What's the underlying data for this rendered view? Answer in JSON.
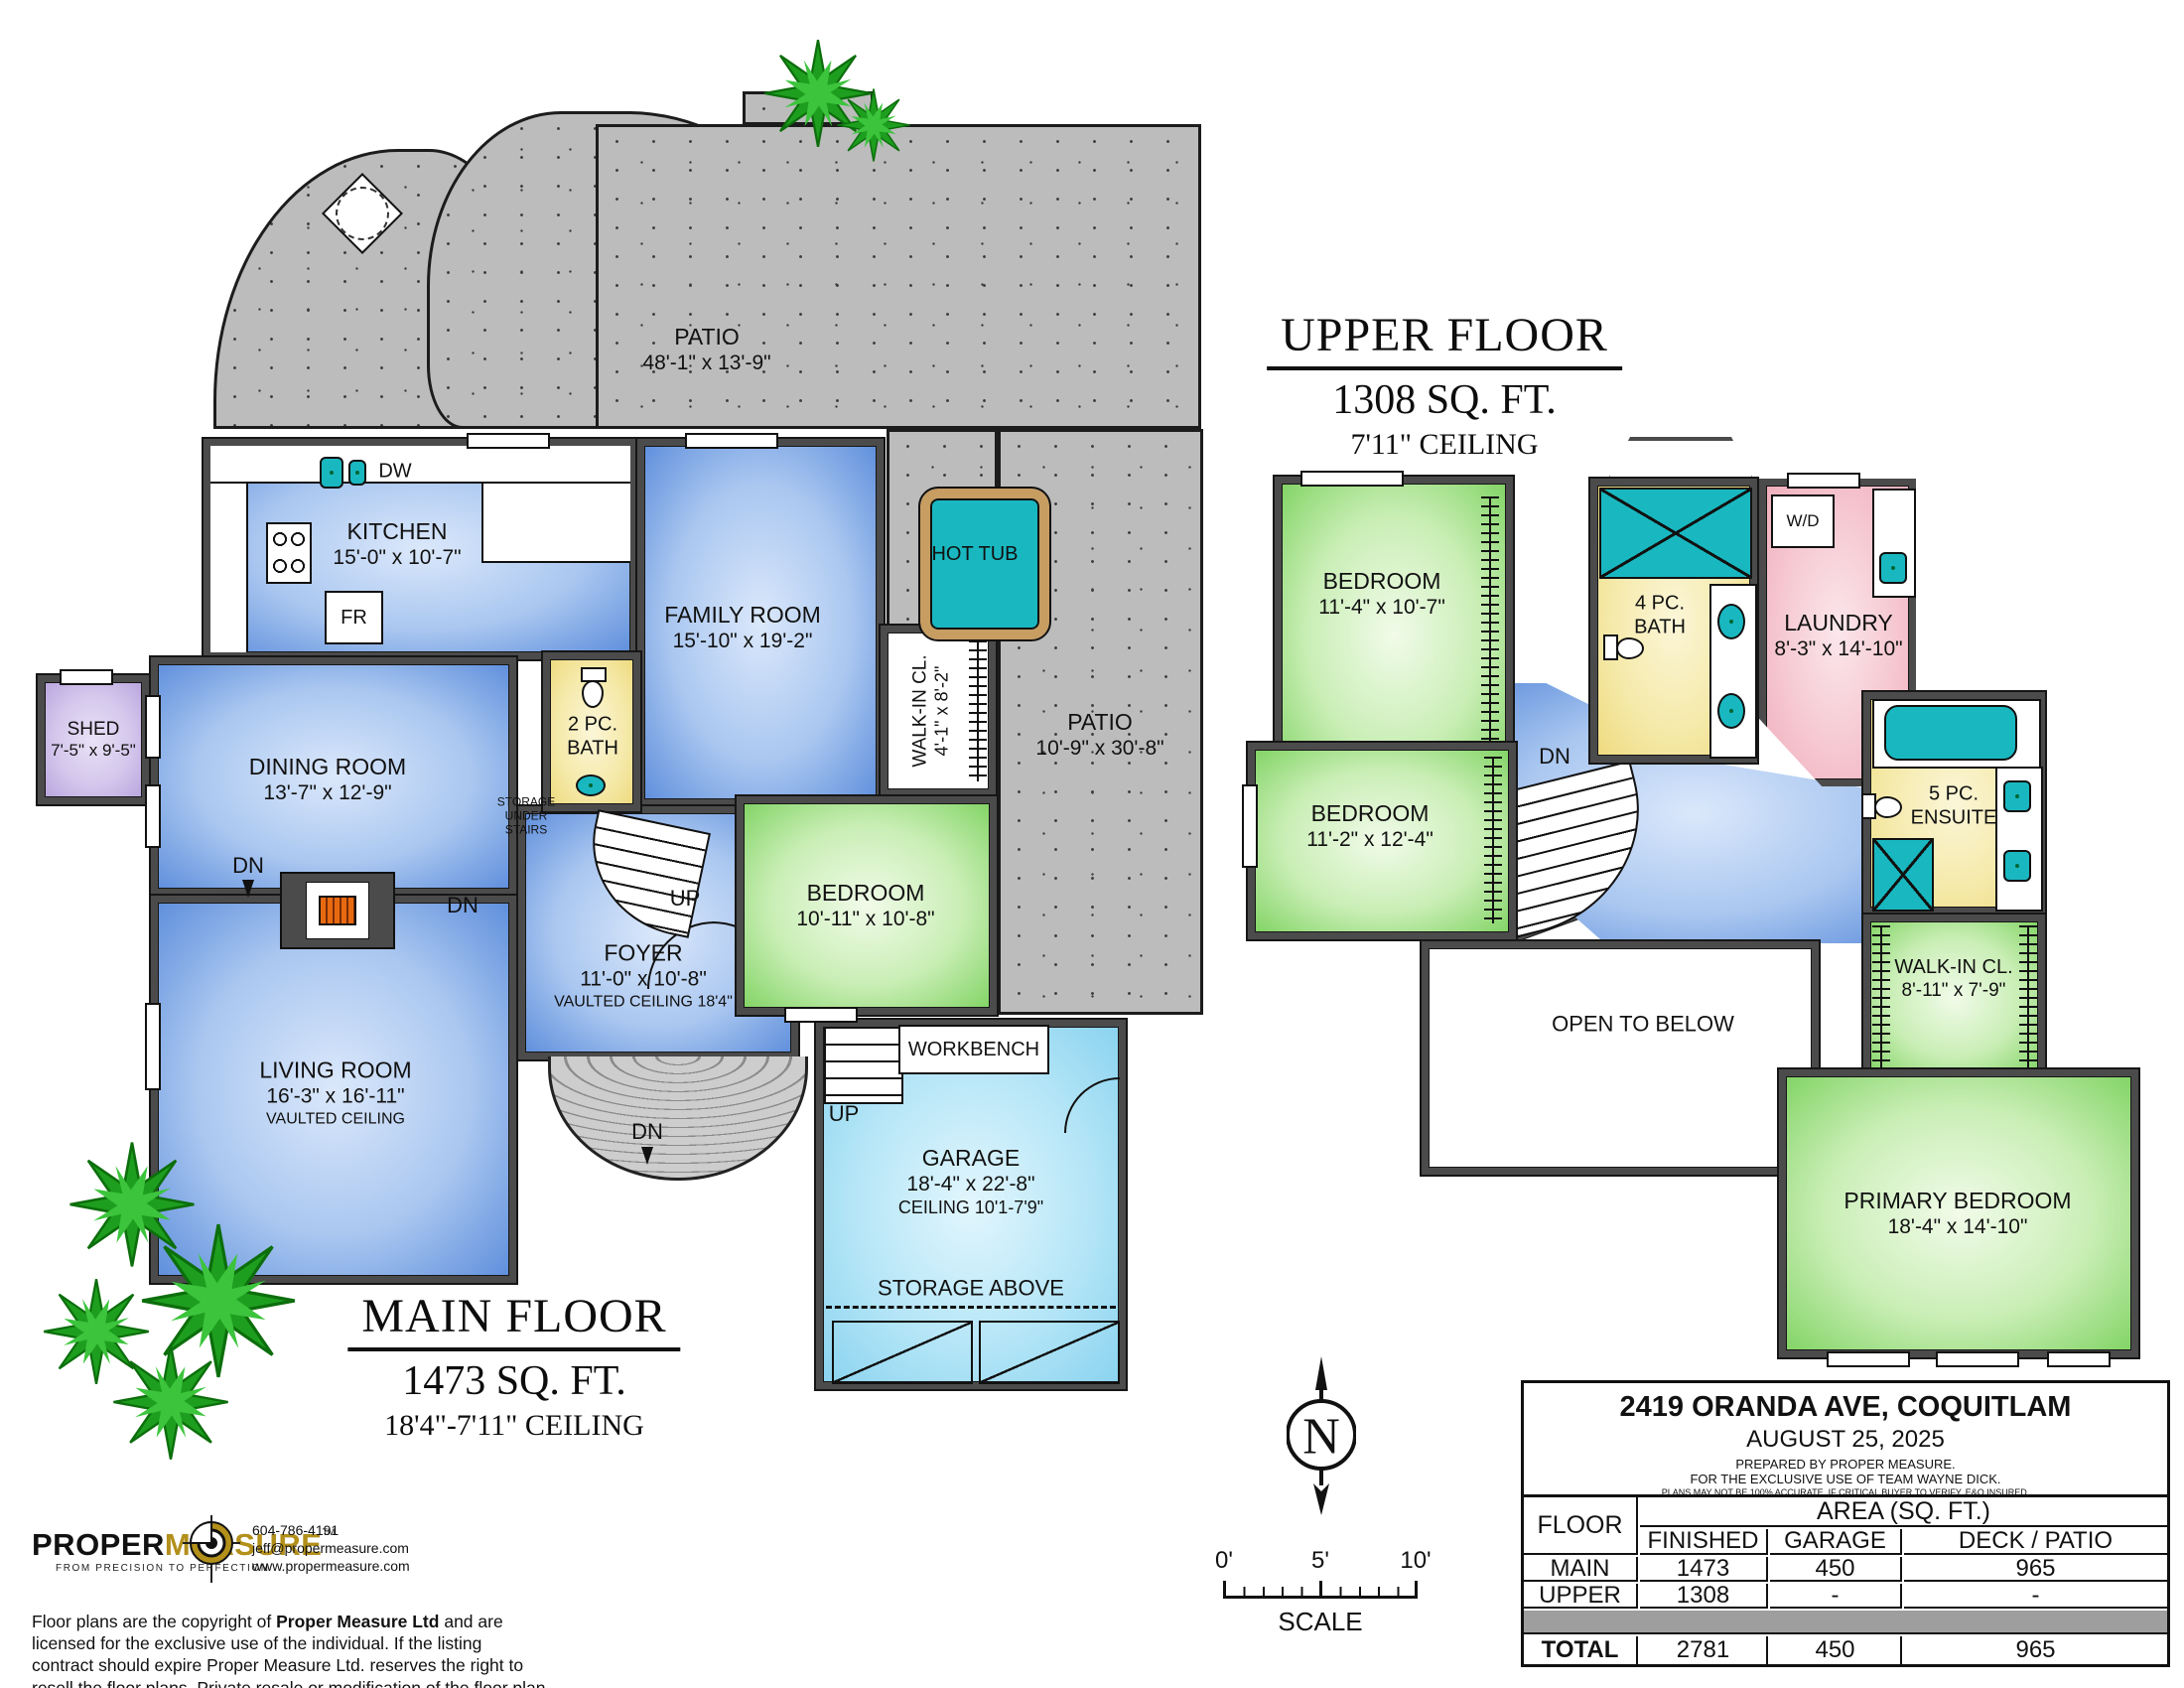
{
  "main": {
    "title": "MAIN FLOOR",
    "area": "1473 SQ. FT.",
    "ceiling": "18'4\"-7'11\" CEILING",
    "patio_top": {
      "name": "PATIO",
      "dims": "48'-1\" x 13'-9\""
    },
    "patio_right": {
      "name": "PATIO",
      "dims": "10'-9\" x 30'-8\""
    },
    "kitchen": {
      "name": "KITCHEN",
      "dims": "15'-0\" x 10'-7\""
    },
    "family": {
      "name": "FAMILY ROOM",
      "dims": "15'-10\" x 19'-2\""
    },
    "dining": {
      "name": "DINING ROOM",
      "dims": "13'-7\" x 12'-9\""
    },
    "living": {
      "name": "LIVING ROOM",
      "dims": "16'-3\" x 16'-11\"",
      "note": "VAULTED CEILING"
    },
    "foyer": {
      "name": "FOYER",
      "dims": "11'-0\" x 10'-8\"",
      "note": "VAULTED CEILING 18'4\""
    },
    "bath": {
      "name": "2 PC.",
      "name2": "BATH"
    },
    "bedroom": {
      "name": "BEDROOM",
      "dims": "10'-11\" x 10'-8\""
    },
    "wic": {
      "name": "WALK-IN CL.",
      "dims": "4'-1\" x 8'-2\""
    },
    "shed": {
      "name": "SHED",
      "dims": "7'-5\" x 9'-5\""
    },
    "garage": {
      "name": "GARAGE",
      "dims": "18'-4\" x 22'-8\"",
      "note": "CEILING 10'1-7'9\""
    },
    "hot_tub": "HOT TUB",
    "workbench": "WORKBENCH",
    "storage_above": "STORAGE ABOVE",
    "storage_under_stairs": "STORAGE UNDER STAIRS",
    "fr": "FR",
    "dw": "DW",
    "up": "UP",
    "dn": "DN"
  },
  "upper": {
    "title": "UPPER FLOOR",
    "area": "1308 SQ. FT.",
    "ceiling": "7'11\" CEILING",
    "bedroom1": {
      "name": "BEDROOM",
      "dims": "11'-4\" x 10'-7\""
    },
    "bedroom2": {
      "name": "BEDROOM",
      "dims": "11'-2\" x 12'-4\""
    },
    "bath": {
      "name": "4 PC.",
      "name2": "BATH"
    },
    "laundry": {
      "name": "LAUNDRY",
      "dims": "8'-3\" x 14'-10\""
    },
    "ensuite": {
      "name": "5 PC.",
      "name2": "ENSUITE"
    },
    "wic": {
      "name": "WALK-IN CL.",
      "dims": "8'-11\" x 7'-9\""
    },
    "primary": {
      "name": "PRIMARY BEDROOM",
      "dims": "18'-4\" x 14'-10\""
    },
    "open_below": "OPEN TO BELOW",
    "wd": "W/D",
    "dn": "DN"
  },
  "compass": {
    "label": "N"
  },
  "scale_bar": {
    "tick0": "0'",
    "tick5": "5'",
    "tick10": "10'",
    "label": "SCALE"
  },
  "title_block": {
    "address": "2419 ORANDA AVE, COQUITLAM",
    "date": "AUGUST 25, 2025",
    "prepared_by": "PREPARED BY PROPER MEASURE.",
    "exclusive": "FOR THE EXCLUSIVE USE OF TEAM WAYNE DICK.",
    "disclaimer": "PLANS MAY NOT BE 100% ACCURATE. IF CRITICAL BUYER TO VERIFY. E&O INSURED.",
    "col_floor": "FLOOR",
    "col_area": "AREA (SQ. FT.)",
    "col_finished": "FINISHED",
    "col_garage": "GARAGE",
    "col_deck": "DECK / PATIO",
    "rows": [
      {
        "floor": "MAIN",
        "finished": "1473",
        "garage": "450",
        "deck": "965"
      },
      {
        "floor": "UPPER",
        "finished": "1308",
        "garage": "-",
        "deck": "-"
      }
    ],
    "total": {
      "floor": "TOTAL",
      "finished": "2781",
      "garage": "450",
      "deck": "965"
    }
  },
  "logo": {
    "brand1": "PROPER",
    "brand2": "MEASURE",
    "tm": "TM",
    "tagline": "FROM PRECISION TO PERFECTION",
    "phone": "604-786-4191",
    "email": "jeff@propermeasure.com",
    "web": "www.propermeasure.com"
  },
  "copyright": {
    "pre": "Floor plans are the copyright of ",
    "bold": "Proper Measure Ltd",
    "post": " and are licensed for the exclusive use of the individual.  If the listing contract should expire Proper Measure Ltd. reserves the right to resell the floor plans.  Private resale or modification of the floor plan to a third party by any individual or entity other than Proper Measure Ltd is strictly prohibited."
  },
  "colors": {
    "room_blue": "#5f8fdc",
    "room_green": "#82d465",
    "garage_cyan": "#8ad3ef",
    "bath_yellow": "#eeda7e",
    "laundry_pink": "#efaebc",
    "shed_purple": "#b9a5de",
    "fixture_teal": "#19b8c0",
    "patio_gray": "#bcbcbc",
    "logo_gold": "#b3901a"
  }
}
